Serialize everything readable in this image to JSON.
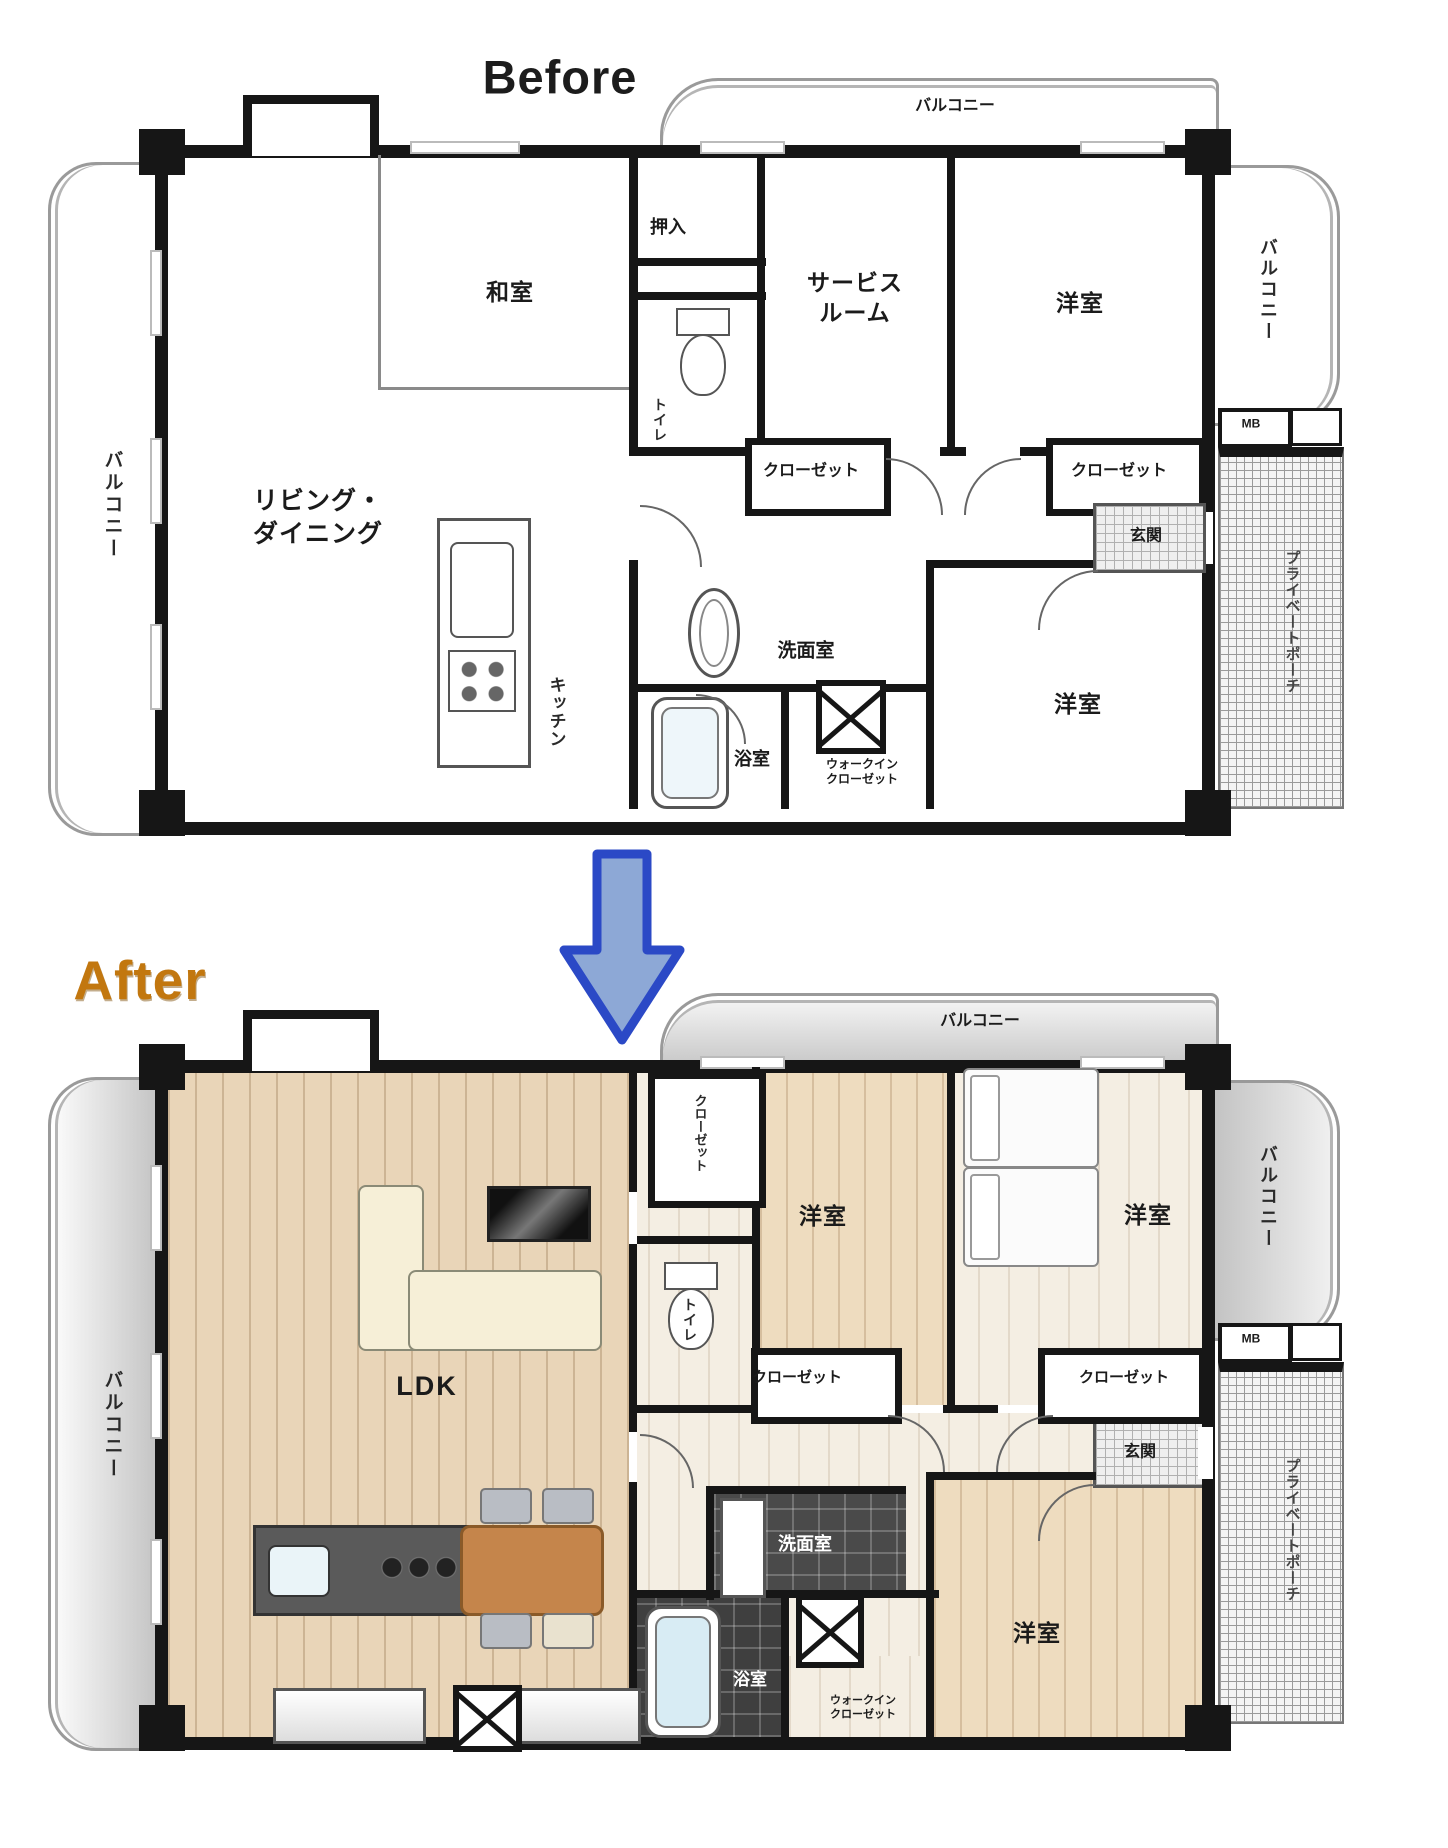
{
  "page": {
    "background": "#ffffff"
  },
  "before": {
    "title": "Before",
    "labels": {
      "balcony_top": "バルコニー",
      "balcony_left": "バルコニー",
      "balcony_right": "バルコニー",
      "private_porch": "プライベートポーチ",
      "meter_box": "MB",
      "oshiire": "押入",
      "washitsu": "和室",
      "service_room": "サービス\nルーム",
      "youshitsu_top_right": "洋室",
      "living_dining": "リビング・\nダイニング",
      "closet_center": "クローゼット",
      "closet_right": "クローゼット",
      "genkan": "玄関",
      "toilet": "トイレ",
      "senmenshitsu": "洗面室",
      "kitchen": "キッチン",
      "bathroom": "浴室",
      "walk_in_closet": "ウォークイン\nクローゼット",
      "youshitsu_bottom_right": "洋室"
    }
  },
  "after": {
    "title": "After",
    "labels": {
      "balcony_top": "バルコニー",
      "balcony_left": "バルコニー",
      "balcony_right": "バルコニー",
      "private_porch": "プライベートポーチ",
      "meter_box": "MB",
      "closet_hall": "クローゼット",
      "ldk": "LDK",
      "youshitsu_center": "洋室",
      "youshitsu_top_right": "洋室",
      "toilet": "トイレ",
      "closet_center": "クローゼット",
      "closet_right": "クローゼット",
      "genkan": "玄関",
      "senmenshitsu": "洗面室",
      "bathroom": "浴室",
      "walk_in_closet": "ウォークイン\nクローゼット",
      "youshitsu_bottom_right": "洋室"
    }
  },
  "arrow": {
    "direction": "down",
    "fill": "#8da8d6",
    "border": "#2b49c6"
  },
  "colors": {
    "wall": "#161616",
    "before_title": "#1c1c1c",
    "after_title": "#c2770f",
    "wood_floor": "#e9d5b8",
    "light_floor": "#f4eee3",
    "dark_tile": "#4a4a4a",
    "table": "#c5854b",
    "sofa": "#f6efd7",
    "tub": "#d8ecf4"
  }
}
